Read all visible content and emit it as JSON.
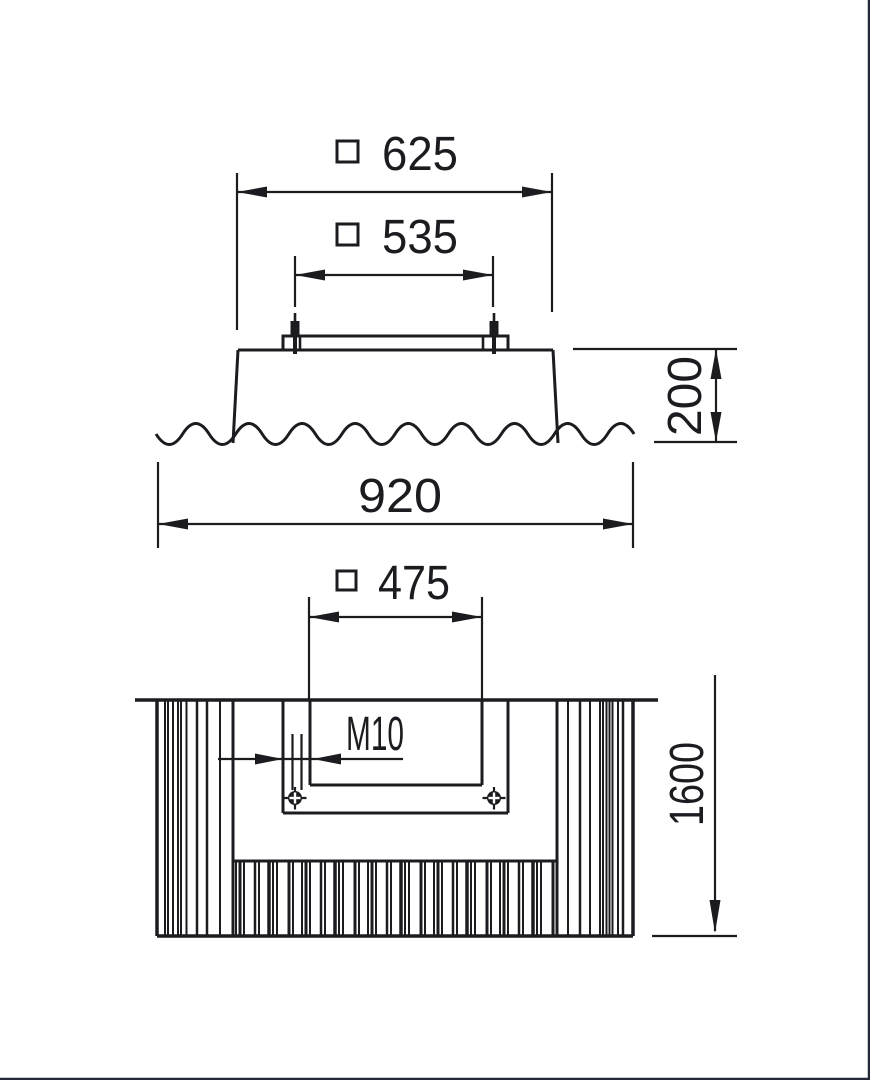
{
  "views": {
    "elevation": {
      "dimensions": [
        {
          "symbol": "square",
          "value": "625"
        },
        {
          "symbol": "square",
          "value": "535"
        },
        {
          "value": "200",
          "orientation": "vertical"
        },
        {
          "value": "920"
        }
      ]
    },
    "plan": {
      "dimensions": [
        {
          "symbol": "square",
          "value": "475"
        },
        {
          "value": "M10",
          "type": "thread-callout"
        },
        {
          "value": "1600",
          "orientation": "vertical"
        }
      ]
    }
  },
  "colors": {
    "line": "#1c1c20",
    "background": "#ffffff",
    "frame": "#232936"
  }
}
